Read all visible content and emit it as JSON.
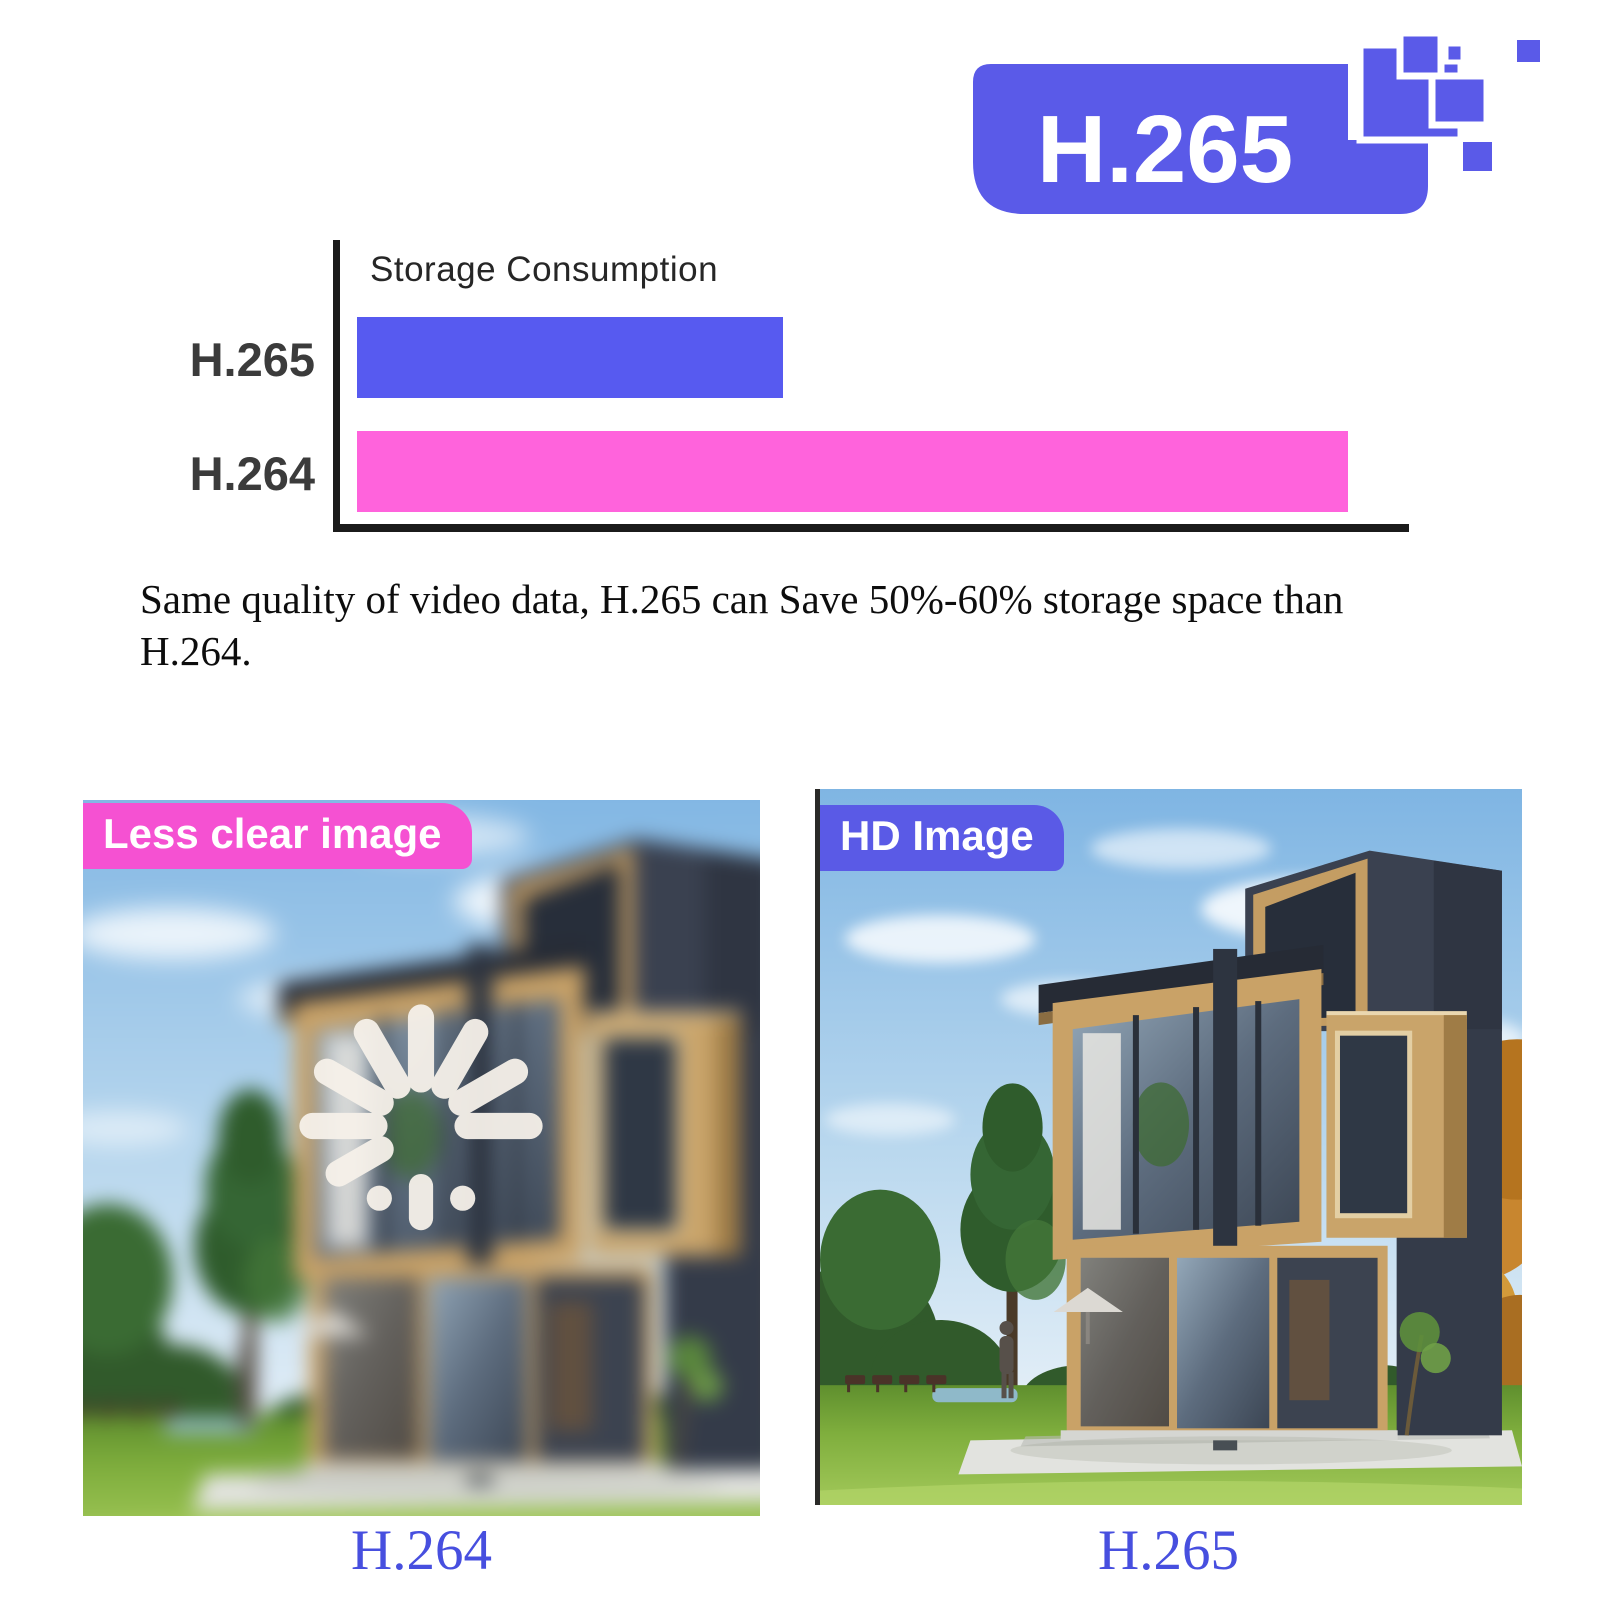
{
  "logo": {
    "label": "H.265"
  },
  "chart_data": {
    "type": "bar",
    "orientation": "horizontal",
    "title": "Storage Consumption",
    "categories": [
      "H.265",
      "H.264"
    ],
    "values": [
      43,
      100
    ],
    "unit": "relative storage consumption (H.264 = 100)",
    "xlabel": "",
    "ylabel": "",
    "xlim": [
      0,
      107
    ],
    "series_colors": [
      "#575af0",
      "#ff63dc"
    ],
    "grid": false,
    "legend": false
  },
  "description": {
    "text": "Same quality of video data, H.265 can Save 50%-60% storage space than H.264.",
    "line1": "Same quality of video data, H.265 can Save 50%-60% storage space than",
    "line2": "H.264."
  },
  "comparison": {
    "left": {
      "badge": "Less clear image",
      "caption": "H.264",
      "badge_color": "#f551d2"
    },
    "right": {
      "badge": "HD Image",
      "caption": "H.265",
      "badge_color": "#5a5ae6"
    }
  },
  "colors": {
    "accent_blue": "#575af0",
    "accent_pink": "#ff63dc",
    "logo_blue": "#5a5ae8",
    "caption_blue": "#474fdf",
    "axis_black": "#1b1b1b"
  }
}
